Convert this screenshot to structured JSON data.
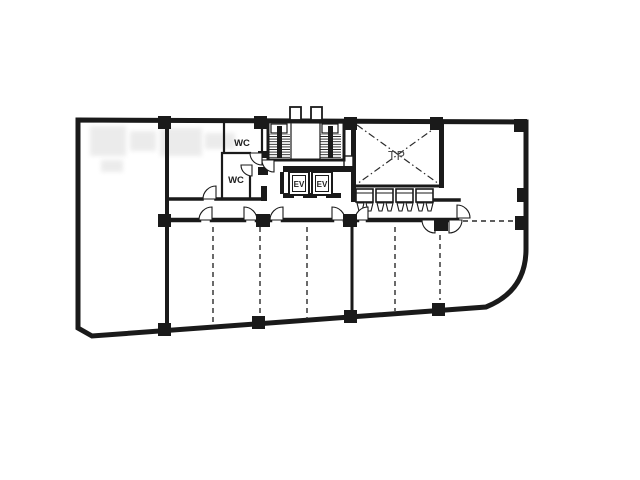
{
  "plan_labels": {
    "wc_upper": "WC",
    "wc_lower": "WC",
    "elevator_left": "EV",
    "elevator_right": "EV",
    "center_shaft": "TP"
  },
  "palette": {
    "ink": "#1a1a1a",
    "paper": "#ffffff",
    "shaft_label_ink": "#4a4a4a"
  }
}
